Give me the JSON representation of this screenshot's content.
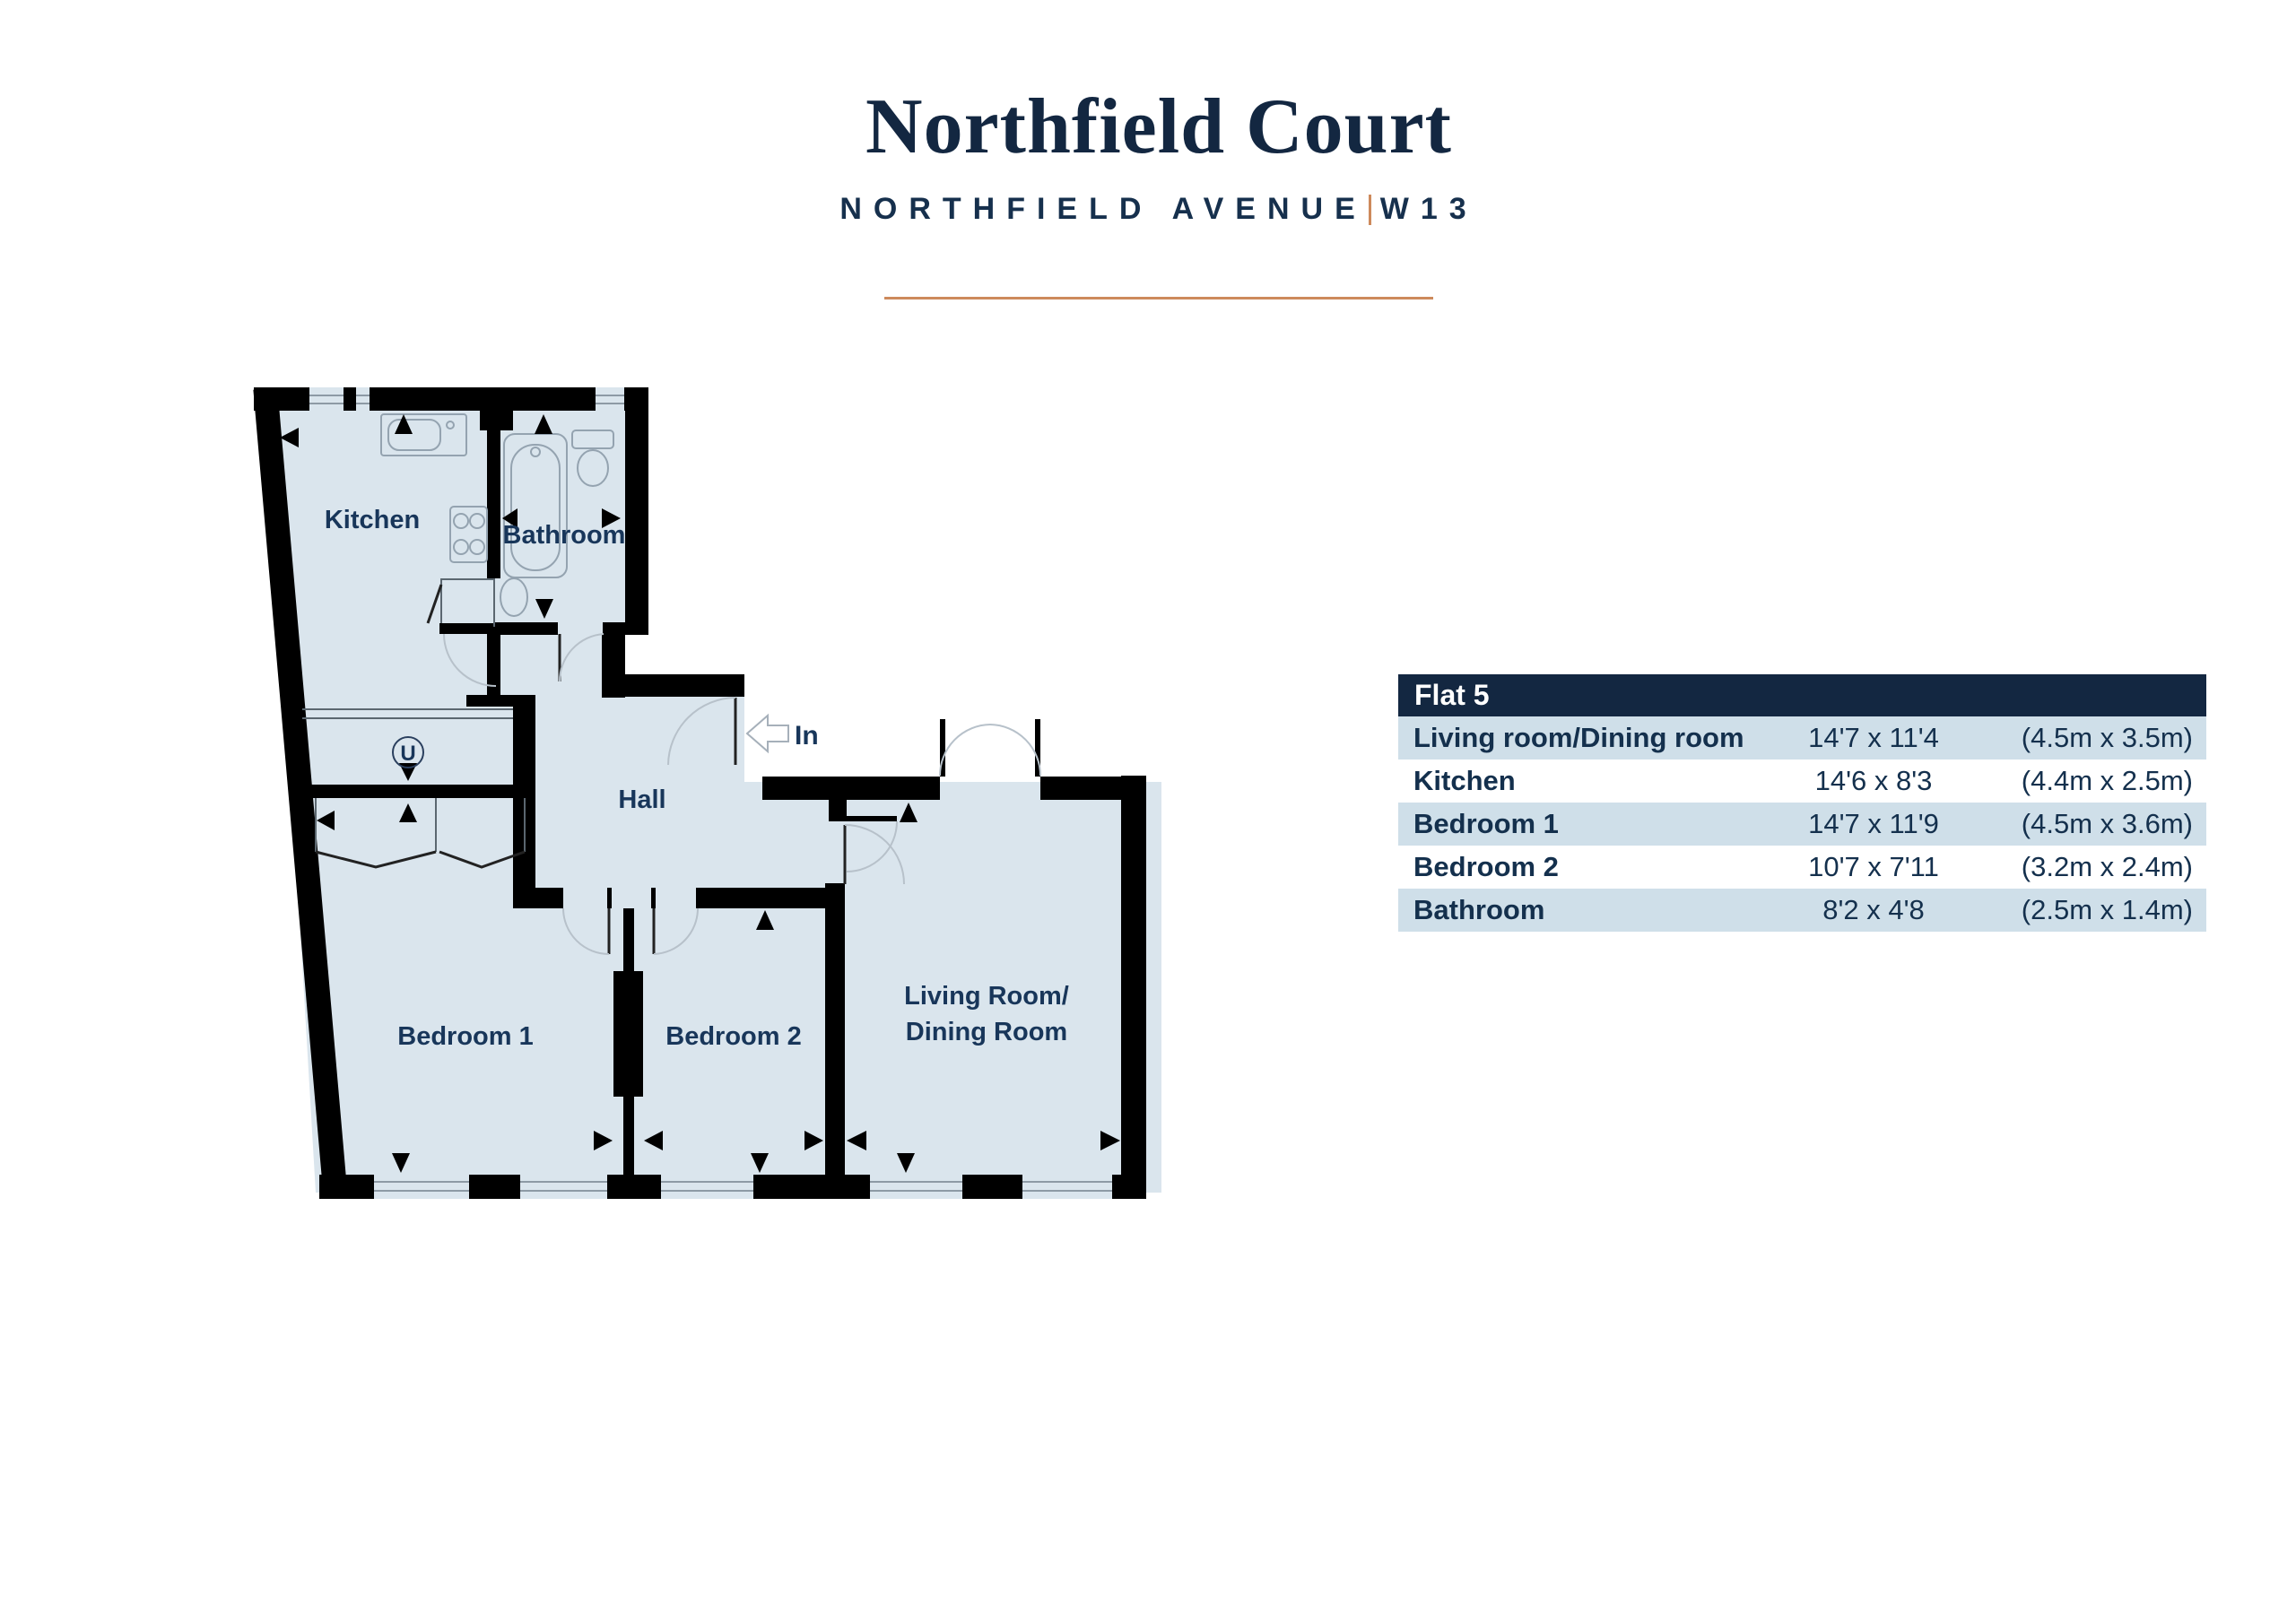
{
  "header": {
    "title": "Northfield Court",
    "subtitle": "NORTHFIELD AVENUE",
    "postcode": "W13"
  },
  "table": {
    "title": "Flat 5",
    "rows": [
      {
        "name": "Living room/Dining room",
        "imperial": "14'7 x 11'4",
        "metric": "(4.5m x 3.5m)"
      },
      {
        "name": "Kitchen",
        "imperial": "14'6 x 8'3",
        "metric": "(4.4m x 2.5m)"
      },
      {
        "name": "Bedroom 1",
        "imperial": "14'7 x 11'9",
        "metric": "(4.5m x 3.6m)"
      },
      {
        "name": "Bedroom 2",
        "imperial": "10'7 x 7'11",
        "metric": "(3.2m x 2.4m)"
      },
      {
        "name": "Bathroom",
        "imperial": "8'2 x 4'8",
        "metric": "(2.5m x 1.4m)"
      }
    ]
  },
  "floorplan": {
    "kitchen": "Kitchen",
    "bathroom": "Bathroom",
    "hall": "Hall",
    "bedroom1": "Bedroom 1",
    "bedroom2": "Bedroom 2",
    "living_line1": "Living Room/",
    "living_line2": "Dining Room",
    "utility": "U",
    "entrance": "In"
  },
  "colors": {
    "navy": "#132741",
    "row_blue": "#cfdfe9",
    "floor": "#dae5ed",
    "orange": "#cd8a5c",
    "text_navy": "#14304d"
  }
}
